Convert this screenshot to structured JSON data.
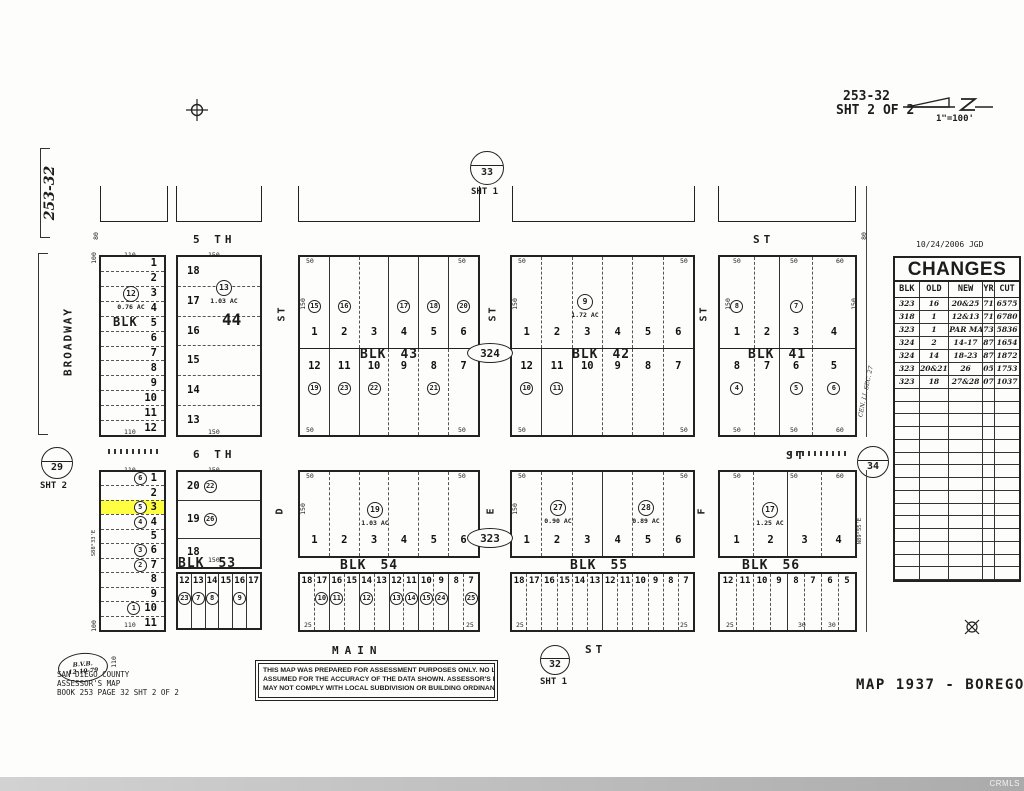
{
  "page": {
    "blk_word": "BLK"
  },
  "header": {
    "sheet_ref": "253-32",
    "sheet_line2": "SHT 2 OF 2",
    "scale": "1\"=100'"
  },
  "left": {
    "sheet_ref_vertical": "253-32",
    "broadway": "BROADWAY"
  },
  "streets": {
    "fifth": "5 TH",
    "fifth_st": "ST",
    "sixth": "6 TH",
    "sixth_st": "ST",
    "main": "MAIN",
    "main_st": "ST",
    "vert_top_1": "ST",
    "vert_top_2": "ST",
    "vert_top_3": "ST",
    "vert_bot_1": "D",
    "vert_bot_2": "E",
    "vert_bot_3": "F"
  },
  "circles": {
    "c33": {
      "num": "33",
      "sub": "SHT 1"
    },
    "c29": {
      "num": "29",
      "sub": "SHT 2"
    },
    "c34": {
      "num": "34"
    },
    "c32": {
      "num": "32",
      "sub": "SHT 1"
    },
    "e324": "324",
    "e323": "323"
  },
  "bearings": {
    "left53": "S88°33'E",
    "right56": "N89°55'E",
    "cenli": "CEN. LI. SEC. 27"
  },
  "blocks": {
    "b6": {
      "num": "6",
      "lots": [
        {
          "n": "1"
        },
        {
          "n": "2"
        },
        {
          "n": "3"
        },
        {
          "n": "4"
        },
        {
          "n": "5"
        },
        {
          "n": "6"
        },
        {
          "n": "7"
        },
        {
          "n": "8"
        },
        {
          "n": "9"
        },
        {
          "n": "10"
        },
        {
          "n": "11"
        },
        {
          "n": "12"
        }
      ]
    },
    "b44": {
      "num": "44",
      "lots": [
        {
          "n": "18"
        },
        {
          "n": "17"
        },
        {
          "n": "16"
        },
        {
          "n": "15"
        },
        {
          "n": "14"
        },
        {
          "n": "13"
        }
      ]
    },
    "b43": {
      "num": "43",
      "top": [
        {
          "n": "1",
          "c": "15"
        },
        {
          "n": "2",
          "c": "16"
        },
        {
          "n": "3",
          "d": true
        },
        {
          "n": "4",
          "c": "17"
        },
        {
          "n": "5",
          "c": "18"
        },
        {
          "n": "6",
          "c": "20"
        }
      ],
      "bottom": [
        {
          "n": "12",
          "c": "19"
        },
        {
          "n": "11",
          "c": "23"
        },
        {
          "n": "10",
          "c": "22"
        },
        {
          "n": "9",
          "d": true
        },
        {
          "n": "8",
          "c": "21",
          "d": true
        },
        {
          "n": "7",
          "d": true
        }
      ]
    },
    "b42": {
      "num": "42",
      "top": [
        {
          "n": "1"
        },
        {
          "n": "2",
          "d": true
        },
        {
          "n": "3",
          "d": true
        },
        {
          "n": "4",
          "d": true
        },
        {
          "n": "5",
          "d": true
        },
        {
          "n": "6",
          "d": true
        }
      ],
      "bottom": [
        {
          "n": "12",
          "c": "10"
        },
        {
          "n": "11",
          "c": "11"
        },
        {
          "n": "10"
        },
        {
          "n": "9",
          "d": true
        },
        {
          "n": "8",
          "d": true
        },
        {
          "n": "7",
          "d": true
        }
      ]
    },
    "b41": {
      "num": "41",
      "top": [
        {
          "n": "1",
          "c": "8",
          "w": 25
        },
        {
          "n": "2",
          "d": true,
          "w": 19
        },
        {
          "n": "3",
          "c": "7",
          "w": 24
        },
        {
          "n": "4",
          "d": true,
          "w": 32
        }
      ],
      "bottom": [
        {
          "n": "8",
          "c": "4",
          "w": 25
        },
        {
          "n": "7",
          "d": true,
          "w": 19
        },
        {
          "n": "6",
          "c": "5",
          "w": 24
        },
        {
          "n": "5",
          "c": "6",
          "d": true,
          "w": 32
        }
      ]
    },
    "b53": {
      "num": "53",
      "left": [
        {
          "n": "1",
          "c": "6"
        },
        {
          "n": "2"
        },
        {
          "n": "3",
          "c": "5",
          "hl": true
        },
        {
          "n": "4",
          "c": "4"
        },
        {
          "n": "5"
        },
        {
          "n": "6",
          "c": "3"
        },
        {
          "n": "7",
          "c": "2"
        },
        {
          "n": "8"
        },
        {
          "n": "9"
        },
        {
          "n": "10",
          "c": "1"
        },
        {
          "n": "11"
        }
      ],
      "right_top": [
        {
          "n": "20",
          "c": "22",
          "h": 28
        },
        {
          "n": "19",
          "c": "26",
          "h": 38
        },
        {
          "n": "18",
          "h": 28
        }
      ],
      "right_bottom": [
        {
          "n": "12",
          "c": "23"
        },
        {
          "n": "13",
          "c": "7"
        },
        {
          "n": "14",
          "c": "8"
        },
        {
          "n": "15"
        },
        {
          "n": "16",
          "c": "9"
        },
        {
          "n": "17"
        }
      ]
    },
    "b54": {
      "num": "54",
      "top": [
        {
          "n": "1"
        },
        {
          "n": "2",
          "d": true
        },
        {
          "n": "3",
          "d": true
        },
        {
          "n": "4",
          "d": true
        },
        {
          "n": "5",
          "d": true
        },
        {
          "n": "6",
          "d": true
        }
      ],
      "strip": [
        {
          "n": "18"
        },
        {
          "n": "17",
          "c": "10",
          "d": true
        },
        {
          "n": "16",
          "c": "11"
        },
        {
          "n": "15",
          "d": true
        },
        {
          "n": "14",
          "c": "12"
        },
        {
          "n": "13",
          "d": true
        },
        {
          "n": "12",
          "c": "13"
        },
        {
          "n": "11",
          "c": "14",
          "d": true
        },
        {
          "n": "10",
          "c": "15"
        },
        {
          "n": "9",
          "c": "24",
          "d": true
        },
        {
          "n": "8"
        },
        {
          "n": "7",
          "c": "25",
          "d": true
        }
      ]
    },
    "b55": {
      "num": "55",
      "top": [
        {
          "n": "1"
        },
        {
          "n": "2",
          "d": true
        },
        {
          "n": "3",
          "d": true
        },
        {
          "n": "4"
        },
        {
          "n": "5",
          "d": true
        },
        {
          "n": "6",
          "d": true
        }
      ],
      "strip": [
        {
          "n": "18"
        },
        {
          "n": "17",
          "d": true
        },
        {
          "n": "16",
          "d": true
        },
        {
          "n": "15",
          "d": true
        },
        {
          "n": "14",
          "d": true
        },
        {
          "n": "13",
          "d": true
        },
        {
          "n": "12"
        },
        {
          "n": "11",
          "d": true
        },
        {
          "n": "10",
          "d": true
        },
        {
          "n": "9",
          "d": true
        },
        {
          "n": "8",
          "d": true
        },
        {
          "n": "7",
          "d": true
        }
      ]
    },
    "b56": {
      "num": "56",
      "top": [
        {
          "n": "1"
        },
        {
          "n": "2",
          "d": true
        },
        {
          "n": "3"
        },
        {
          "n": "4",
          "d": true
        }
      ],
      "strip": [
        {
          "n": "12"
        },
        {
          "n": "11",
          "d": true
        },
        {
          "n": "10",
          "d": true
        },
        {
          "n": "9",
          "d": true
        },
        {
          "n": "8"
        },
        {
          "n": "7",
          "d": true
        },
        {
          "n": "6",
          "d": true
        },
        {
          "n": "5",
          "d": true
        }
      ]
    }
  },
  "notes": [
    {
      "c": "12",
      "ac": "0.76 AC",
      "x": 131,
      "y": 286
    },
    {
      "c": "13",
      "ac": "1.03 AC",
      "x": 224,
      "y": 280
    },
    {
      "c": "9",
      "ac": "1.72 AC",
      "x": 585,
      "y": 294
    },
    {
      "c": "19",
      "ac": "1.03 AC",
      "x": 375,
      "y": 502
    },
    {
      "c": "27",
      "ac": "0.90 AC",
      "x": 558,
      "y": 500
    },
    {
      "c": "28",
      "ac": "0.89 AC",
      "x": 646,
      "y": 500
    },
    {
      "c": "17",
      "ac": "1.25 AC",
      "x": 770,
      "y": 502
    }
  ],
  "dims": [
    {
      "t": "110",
      "x": 124,
      "y": 251
    },
    {
      "t": "110",
      "x": 124,
      "y": 428
    },
    {
      "t": "150",
      "x": 208,
      "y": 251
    },
    {
      "t": "150",
      "x": 208,
      "y": 428
    },
    {
      "t": "50",
      "x": 306,
      "y": 257
    },
    {
      "t": "50",
      "x": 458,
      "y": 257
    },
    {
      "t": "50",
      "x": 306,
      "y": 426
    },
    {
      "t": "50",
      "x": 458,
      "y": 426
    },
    {
      "t": "150",
      "x": 297,
      "y": 300,
      "r": 1
    },
    {
      "t": "50",
      "x": 518,
      "y": 257
    },
    {
      "t": "50",
      "x": 680,
      "y": 257
    },
    {
      "t": "50",
      "x": 518,
      "y": 426
    },
    {
      "t": "50",
      "x": 680,
      "y": 426
    },
    {
      "t": "150",
      "x": 509,
      "y": 300,
      "r": 1
    },
    {
      "t": "50",
      "x": 733,
      "y": 257
    },
    {
      "t": "50",
      "x": 790,
      "y": 257
    },
    {
      "t": "60",
      "x": 836,
      "y": 257
    },
    {
      "t": "50",
      "x": 733,
      "y": 426
    },
    {
      "t": "50",
      "x": 790,
      "y": 426
    },
    {
      "t": "60",
      "x": 836,
      "y": 426
    },
    {
      "t": "150",
      "x": 722,
      "y": 300,
      "r": 1
    },
    {
      "t": "150",
      "x": 848,
      "y": 300,
      "r": 1
    },
    {
      "t": "110",
      "x": 124,
      "y": 466
    },
    {
      "t": "110",
      "x": 124,
      "y": 621
    },
    {
      "t": "150",
      "x": 208,
      "y": 466
    },
    {
      "t": "150",
      "x": 208,
      "y": 556
    },
    {
      "t": "50",
      "x": 306,
      "y": 472
    },
    {
      "t": "50",
      "x": 458,
      "y": 472
    },
    {
      "t": "25",
      "x": 304,
      "y": 621
    },
    {
      "t": "25",
      "x": 466,
      "y": 621
    },
    {
      "t": "150",
      "x": 297,
      "y": 505,
      "r": 1
    },
    {
      "t": "50",
      "x": 518,
      "y": 472
    },
    {
      "t": "50",
      "x": 680,
      "y": 472
    },
    {
      "t": "25",
      "x": 516,
      "y": 621
    },
    {
      "t": "25",
      "x": 680,
      "y": 621
    },
    {
      "t": "150",
      "x": 509,
      "y": 505,
      "r": 1
    },
    {
      "t": "50",
      "x": 733,
      "y": 472
    },
    {
      "t": "50",
      "x": 790,
      "y": 472
    },
    {
      "t": "60",
      "x": 836,
      "y": 472
    },
    {
      "t": "25",
      "x": 726,
      "y": 621
    },
    {
      "t": "30",
      "x": 798,
      "y": 621
    },
    {
      "t": "30",
      "x": 828,
      "y": 621
    },
    {
      "t": "100",
      "x": 88,
      "y": 254,
      "r": 1
    },
    {
      "t": "100",
      "x": 88,
      "y": 622,
      "r": 1
    },
    {
      "t": "80",
      "x": 92,
      "y": 232,
      "r": 1
    },
    {
      "t": "80",
      "x": 860,
      "y": 232,
      "r": 1
    },
    {
      "t": "110",
      "x": 108,
      "y": 658,
      "r": 1
    }
  ],
  "changes": {
    "date_line": "10/24/2006  JGD",
    "title": "CHANGES",
    "headers": [
      "BLK",
      "OLD",
      "NEW",
      "YR",
      "CUT"
    ],
    "rows": [
      [
        "323",
        "16",
        "20&25",
        "71",
        "6575"
      ],
      [
        "318",
        "1",
        "12&13",
        "71",
        "6780"
      ],
      [
        "323",
        "1",
        "PAR MAP",
        "73",
        "5836"
      ],
      [
        "324",
        "2",
        "14-17",
        "87",
        "1654"
      ],
      [
        "324",
        "14",
        "18-23",
        "87",
        "1872"
      ],
      [
        "323",
        "20&21",
        "26",
        "05",
        "1753"
      ],
      [
        "323",
        "18",
        "27&28",
        "07",
        "1037"
      ]
    ],
    "blank_rows": 15
  },
  "footer": {
    "stamp_line1": "B.V.B.",
    "stamp_line2": "12-10-79",
    "county": "SAN DIEGO COUNTY\nASSESSOR'S MAP\nBOOK 253 PAGE 32 SHT 2 OF 2",
    "disclaimer1": "THIS MAP WAS PREPARED FOR ASSESSMENT PURPOSES ONLY.  NO LIABILITY IS",
    "disclaimer2": "ASSUMED FOR THE ACCURACY OF THE DATA SHOWN.  ASSESSOR'S PARCELS",
    "disclaimer3": "MAY  NOT  COMPLY  WITH  LOCAL  SUBDIVISION  OR  BUILDING  ORDINANCES.",
    "map_title": "MAP 1937 - BOREGO",
    "watermark": "CRMLS"
  }
}
